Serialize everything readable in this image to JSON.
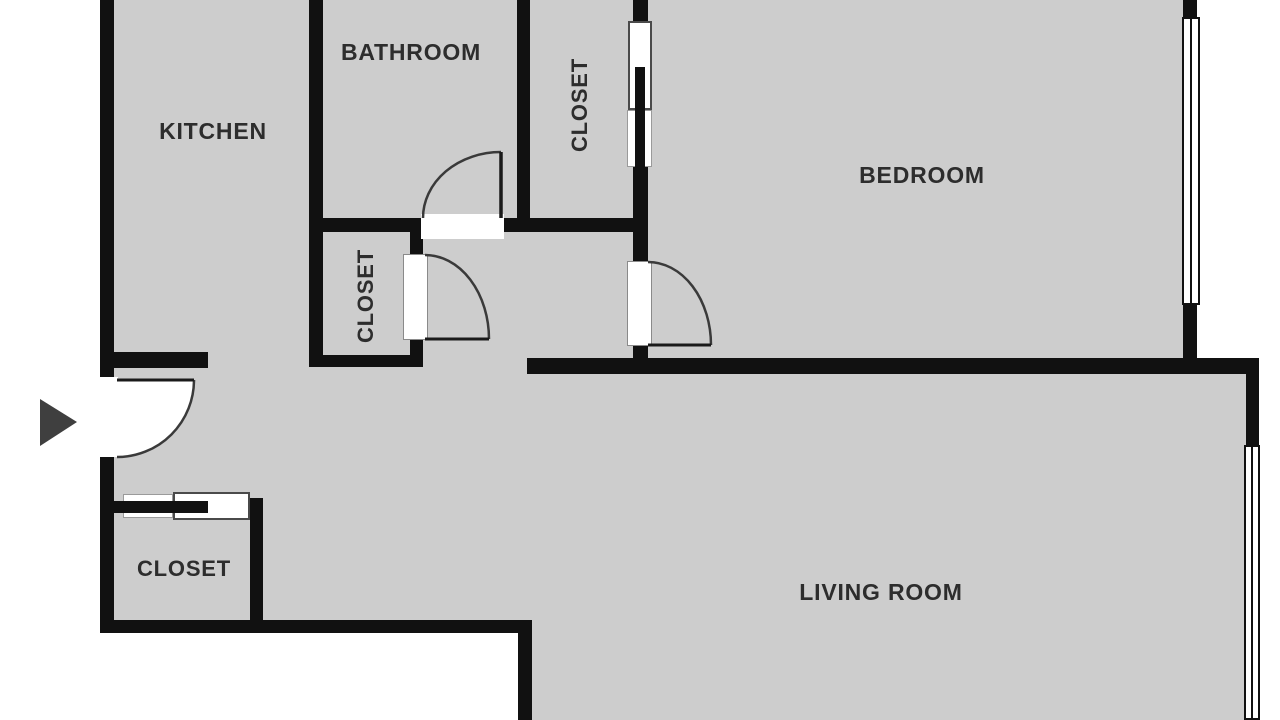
{
  "plan_title": "Apartment floor plan",
  "rooms": {
    "kitchen": {
      "label": "KITCHEN"
    },
    "bathroom": {
      "label": "BATHROOM"
    },
    "closet_top": {
      "label": "CLOSET"
    },
    "closet_middle": {
      "label": "CLOSET"
    },
    "closet_entry": {
      "label": "CLOSET"
    },
    "bedroom": {
      "label": "BEDROOM"
    },
    "living_room": {
      "label": "LIVING ROOM"
    }
  },
  "icons": {
    "entrance_arrow": "triangle-right-entrance-marker",
    "doors": "quarter-circle-swing-doors",
    "windows": "double-line-windows",
    "sliding_doors": "bypass-sliding-door-panels"
  },
  "colors": {
    "floor": "#cdcdcd",
    "wall": "#111111",
    "door_stroke": "#3a3a3a",
    "leaf_stroke": "#1a1a1a",
    "arrow": "#3f3f3f",
    "text": "#2d2d2d",
    "panel_dark": "#4a4a4a",
    "panel_light": "#9a9a9a"
  }
}
